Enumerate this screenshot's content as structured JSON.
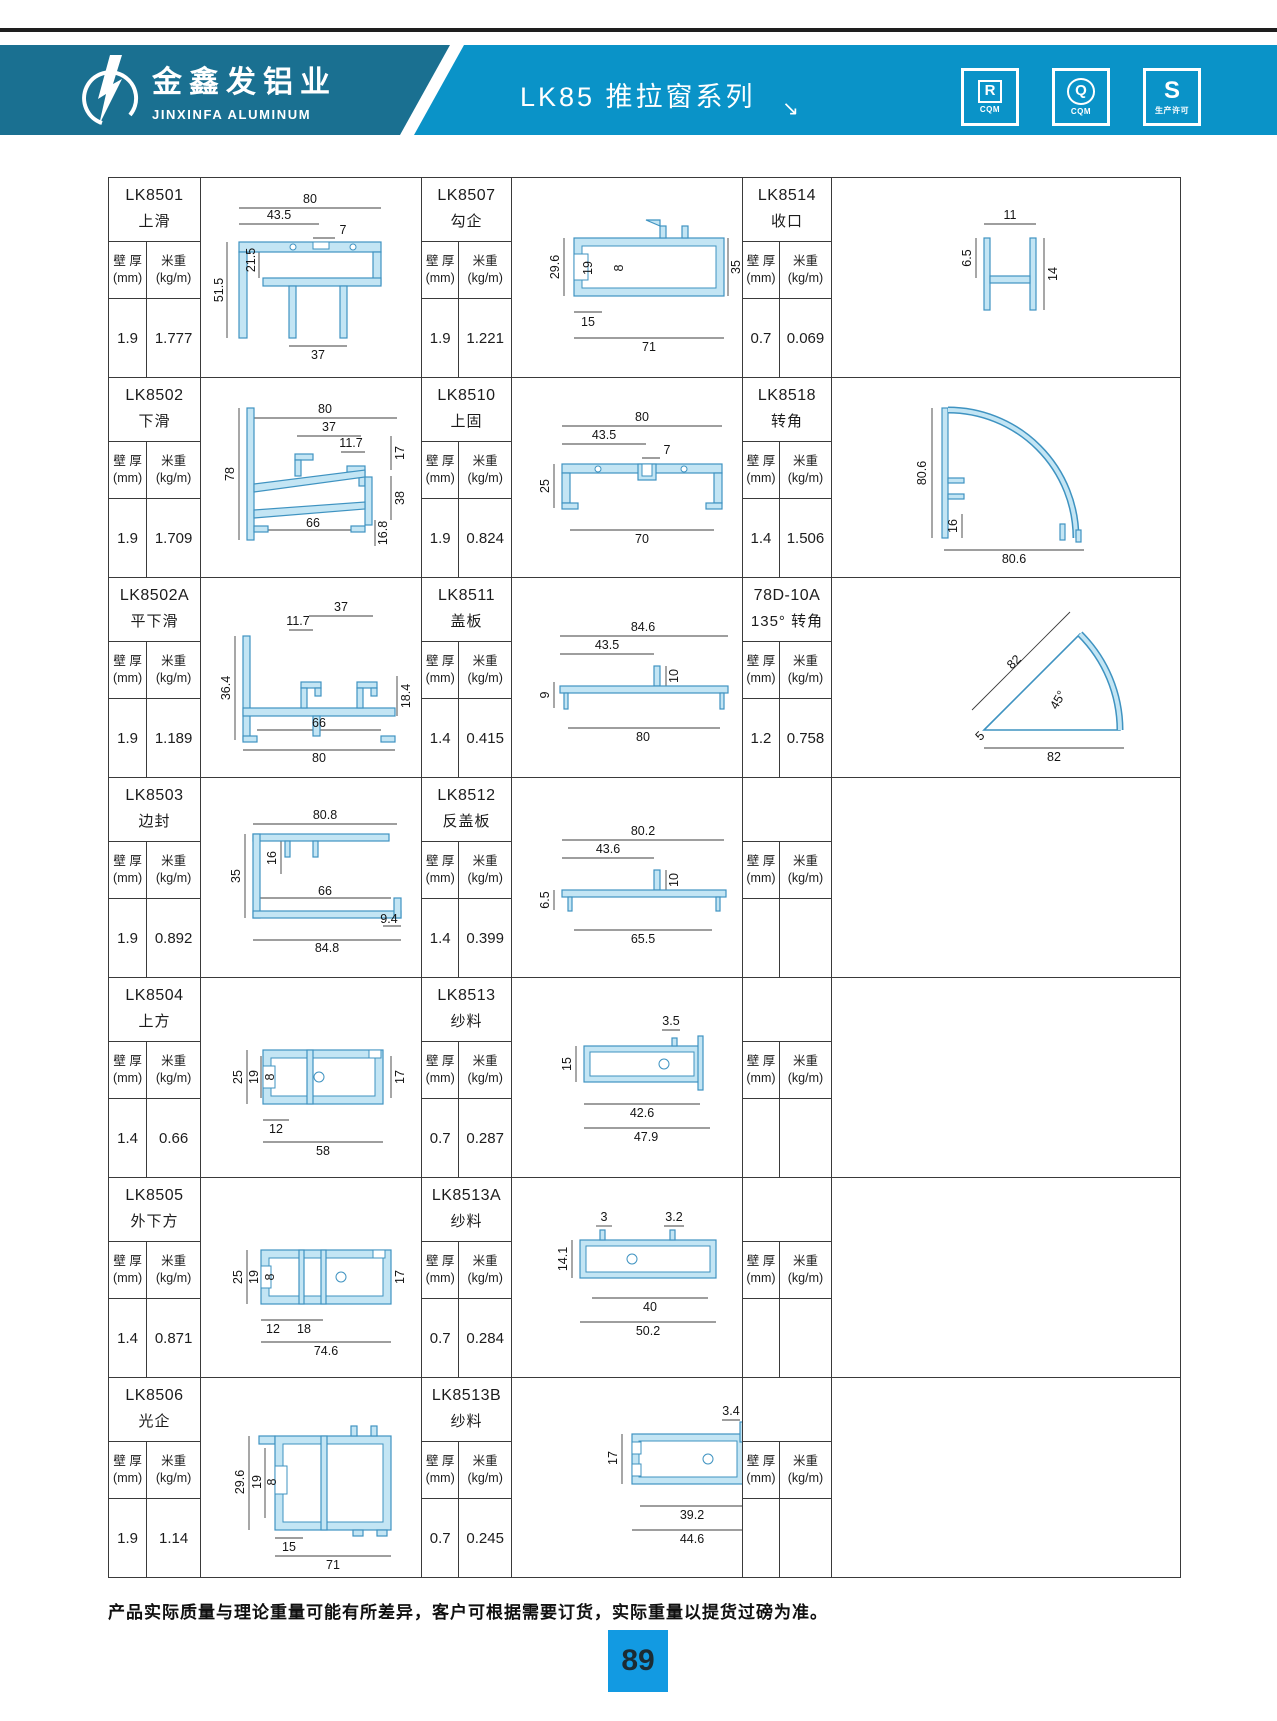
{
  "header": {
    "brand_cn": "金鑫发铝业",
    "brand_en": "JINXINFA ALUMINUM",
    "series_title": "LK85 推拉窗系列",
    "arrow": "↘",
    "badges": [
      {
        "letter": "R",
        "sub": "CQM"
      },
      {
        "letter": "Q",
        "sub": "CQM"
      },
      {
        "letter": "S",
        "sub": "生产许可"
      }
    ]
  },
  "colors": {
    "band_left": "#1a7091",
    "band_right": "#0a93c8",
    "page_badge": "#129ae2",
    "profile_fill": "#c3e5f4",
    "profile_stroke": "#3f93c1"
  },
  "table": {
    "col_headers": {
      "wall": "壁 厚",
      "wall_unit": "(mm)",
      "weight": "米重",
      "weight_unit": "(kg/m)"
    },
    "cells": [
      {
        "code": "LK8501",
        "name": "上滑",
        "wall": "1.9",
        "weight": "1.777",
        "dims": [
          "80",
          "43.5",
          "7",
          "21.5",
          "51.5",
          "37"
        ]
      },
      {
        "code": "LK8507",
        "name": "勾企",
        "wall": "1.9",
        "weight": "1.221",
        "dims": [
          "29.6",
          "19",
          "8",
          "15",
          "71",
          "35"
        ]
      },
      {
        "code": "LK8514",
        "name": "收口",
        "wall": "0.7",
        "weight": "0.069",
        "dims": [
          "11",
          "6.5",
          "14"
        ]
      },
      {
        "code": "LK8502",
        "name": "下滑",
        "wall": "1.9",
        "weight": "1.709",
        "dims": [
          "80",
          "37",
          "11.7",
          "78",
          "17",
          "38",
          "66",
          "16.8"
        ]
      },
      {
        "code": "LK8510",
        "name": "上固",
        "wall": "1.9",
        "weight": "0.824",
        "dims": [
          "80",
          "43.5",
          "7",
          "25",
          "70"
        ]
      },
      {
        "code": "LK8518",
        "name": "转角",
        "wall": "1.4",
        "weight": "1.506",
        "dims": [
          "80.6",
          "16",
          "80.6"
        ]
      },
      {
        "code": "LK8502A",
        "name": "平下滑",
        "wall": "1.9",
        "weight": "1.189",
        "dims": [
          "37",
          "11.7",
          "36.4",
          "18.4",
          "66",
          "80"
        ]
      },
      {
        "code": "LK8511",
        "name": "盖板",
        "wall": "1.4",
        "weight": "0.415",
        "dims": [
          "84.6",
          "43.5",
          "10",
          "9",
          "80"
        ]
      },
      {
        "code": "78D-10A",
        "name": "135° 转角",
        "wall": "1.2",
        "weight": "0.758",
        "dims": [
          "82",
          "45°",
          "5",
          "82"
        ]
      },
      {
        "code": "LK8503",
        "name": "边封",
        "wall": "1.9",
        "weight": "0.892",
        "dims": [
          "80.8",
          "16",
          "35",
          "66",
          "84.8",
          "9.4"
        ]
      },
      {
        "code": "LK8512",
        "name": "反盖板",
        "wall": "1.4",
        "weight": "0.399",
        "dims": [
          "80.2",
          "43.6",
          "10",
          "6.5",
          "65.5"
        ]
      },
      {
        "code": "",
        "name": "",
        "wall": "",
        "weight": "",
        "dims": []
      },
      {
        "code": "LK8504",
        "name": "上方",
        "wall": "1.4",
        "weight": "0.66",
        "dims": [
          "25",
          "19",
          "8",
          "17",
          "12",
          "58"
        ]
      },
      {
        "code": "LK8513",
        "name": "纱料",
        "wall": "0.7",
        "weight": "0.287",
        "dims": [
          "3.5",
          "15",
          "42.6",
          "47.9"
        ]
      },
      {
        "code": "",
        "name": "",
        "wall": "",
        "weight": "",
        "dims": []
      },
      {
        "code": "LK8505",
        "name": "外下方",
        "wall": "1.4",
        "weight": "0.871",
        "dims": [
          "25",
          "19",
          "8",
          "17",
          "12",
          "18",
          "74.6"
        ]
      },
      {
        "code": "LK8513A",
        "name": "纱料",
        "wall": "0.7",
        "weight": "0.284",
        "dims": [
          "3",
          "3.2",
          "14.1",
          "40",
          "50.2"
        ]
      },
      {
        "code": "",
        "name": "",
        "wall": "",
        "weight": "",
        "dims": []
      },
      {
        "code": "LK8506",
        "name": "光企",
        "wall": "1.9",
        "weight": "1.14",
        "dims": [
          "29.6",
          "19",
          "8",
          "15",
          "71"
        ]
      },
      {
        "code": "LK8513B",
        "name": "纱料",
        "wall": "0.7",
        "weight": "0.245",
        "dims": [
          "3.4",
          "17",
          "39.2",
          "44.6"
        ]
      },
      {
        "code": "",
        "name": "",
        "wall": "",
        "weight": "",
        "dims": []
      }
    ]
  },
  "footer": {
    "note": "产品实际质量与理论重量可能有所差异，客户可根据需要订货，实际重量以提货过磅为准。",
    "page": "89"
  }
}
